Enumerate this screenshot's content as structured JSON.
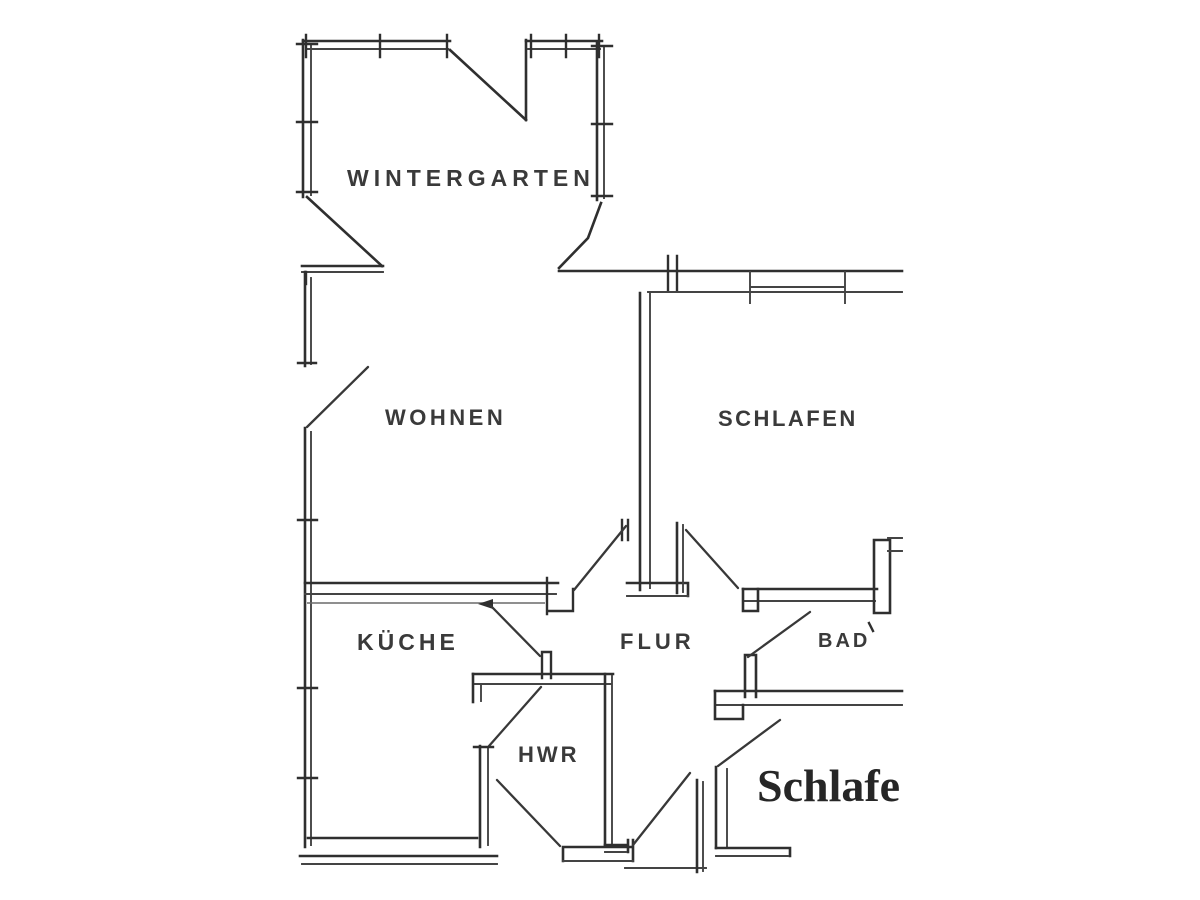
{
  "image": {
    "type": "scanned-floor-plan",
    "background_color": "#ffffff",
    "line_color": "#2f2f2f"
  },
  "rooms": [
    {
      "id": "wintergarten",
      "label": "WINTERGARTEN"
    },
    {
      "id": "wohnen",
      "label": "WOHNEN"
    },
    {
      "id": "schlafen",
      "label": "SCHLAFEN"
    },
    {
      "id": "kueche",
      "label": "KÜCHE"
    },
    {
      "id": "flur",
      "label": "FLUR"
    },
    {
      "id": "bad",
      "label": "BAD"
    },
    {
      "id": "hwr",
      "label": "HWR"
    },
    {
      "id": "schlafen2",
      "label": "Schlafe"
    }
  ]
}
